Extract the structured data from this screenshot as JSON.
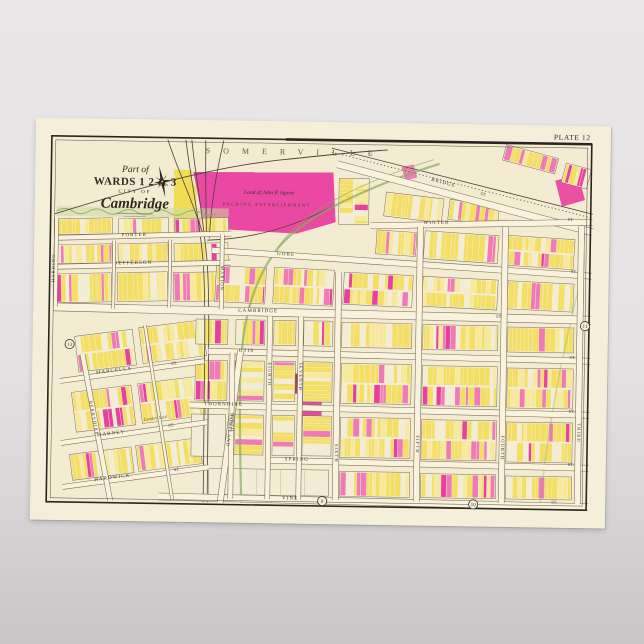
{
  "map": {
    "plate_label": "PLATE 12",
    "boundary_label": "SOMERVILLE",
    "title": {
      "part_of": "Part of",
      "wards": "WARDS 1 2 & 3",
      "city_of": "CITY OF",
      "name": "Cambridge"
    },
    "landmark": {
      "line1": "Land of John P. Squire",
      "line2": "PACKING ESTABLISHMENT"
    },
    "labels": {
      "lumber": "Lumber Yard"
    },
    "plate_refs": [
      {
        "n": "13",
        "x": 37,
        "y": 226
      },
      {
        "n": "11",
        "x": 552,
        "y": 200
      },
      {
        "n": "9",
        "x": 292,
        "y": 379
      },
      {
        "n": "10",
        "x": 443,
        "y": 380
      }
    ],
    "colors": {
      "paper_margin": "#f5efda",
      "paper_map": "#f3ecd2",
      "block": "#f4edd5",
      "line": "#7a6a52",
      "frame": "#2a251e",
      "ink": "#3c352b",
      "street_paper": "#f8f2de",
      "yellow": "#f2df63",
      "pale_yellow": "#f7e99b",
      "pink": "#ef7ab5",
      "magenta": "#e93f9f",
      "maroon": "#a84458",
      "green": "#88a95b",
      "rail": "#4a433a"
    },
    "seed": 11,
    "streets": [
      {
        "l": "BRIDGE",
        "x1": 302,
        "y1": 42,
        "x2": 558,
        "y2": 106,
        "w": 7,
        "lx": 408,
        "ly": 60,
        "lr": 14,
        "l2": {
          "t": "ST",
          "x": 448,
          "y": 71,
          "r": 14
        }
      },
      {
        "l": "WINTER",
        "x1": 336,
        "y1": 103,
        "x2": 558,
        "y2": 96,
        "w": 6,
        "lx": 402,
        "ly": 100,
        "lr": -2,
        "l2": {
          "t": "ST",
          "x": 536,
          "y": 95,
          "r": -2
        }
      },
      {
        "l": "GORE",
        "x1": 178,
        "y1": 130,
        "x2": 558,
        "y2": 150,
        "w": 6,
        "lx": 252,
        "ly": 134,
        "lr": 3,
        "l2": {
          "t": "ST",
          "x": 540,
          "y": 147,
          "r": 3
        }
      },
      {
        "l": "CAMBRIDGE",
        "x1": 20,
        "y1": 189,
        "x2": 558,
        "y2": 194,
        "w": 8,
        "lx": 225,
        "ly": 191,
        "lr": 0,
        "l2": {
          "t": "ST",
          "x": 466,
          "y": 193,
          "r": 0
        }
      },
      {
        "l": "OTIS",
        "x1": 176,
        "y1": 231,
        "x2": 558,
        "y2": 235,
        "w": 6,
        "lx": 214,
        "ly": 231,
        "lr": 0,
        "l2": {
          "t": "ST",
          "x": 540,
          "y": 233,
          "r": 0
        }
      },
      {
        "l": "THORNDIKE",
        "x1": 158,
        "y1": 285,
        "x2": 558,
        "y2": 289,
        "w": 6,
        "lx": 192,
        "ly": 285,
        "lr": 0,
        "l2": {
          "t": "ST",
          "x": 540,
          "y": 287,
          "r": 0
        }
      },
      {
        "l": "SPRING",
        "x1": 234,
        "y1": 339,
        "x2": 558,
        "y2": 342,
        "w": 6,
        "lx": 266,
        "ly": 339,
        "lr": 0,
        "l2": {
          "t": "ST",
          "x": 540,
          "y": 340,
          "r": 0
        }
      },
      {
        "l": "VINE",
        "x1": 128,
        "y1": 377,
        "x2": 558,
        "y2": 381,
        "w": 7,
        "lx": 260,
        "ly": 378,
        "lr": 0,
        "l2": {
          "t": "ST",
          "x": 524,
          "y": 378,
          "r": 0
        }
      },
      {
        "l": "PORTER",
        "x1": 20,
        "y1": 120,
        "x2": 197,
        "y2": 113,
        "w": 5,
        "lx": 100,
        "ly": 117,
        "lr": -2
      },
      {
        "l": "JEFFERSON",
        "x1": 20,
        "y1": 149,
        "x2": 197,
        "y2": 142,
        "w": 5,
        "lx": 100,
        "ly": 145,
        "lr": -2
      },
      {
        "l": "MARCELLA",
        "x1": 28,
        "y1": 263,
        "x2": 172,
        "y2": 241,
        "w": 5,
        "lx": 82,
        "ly": 253,
        "lr": -8,
        "l2": {
          "t": "ST",
          "x": 142,
          "y": 245,
          "r": -8
        }
      },
      {
        "l": "MARNEY",
        "x1": 30,
        "y1": 325,
        "x2": 176,
        "y2": 302,
        "w": 5,
        "lx": 80,
        "ly": 316,
        "lr": -8,
        "l2": {
          "t": "ST",
          "x": 140,
          "y": 307,
          "r": -8
        }
      },
      {
        "l": "HARDWICK",
        "x1": 32,
        "y1": 369,
        "x2": 178,
        "y2": 347,
        "w": 5,
        "lx": 82,
        "ly": 360,
        "lr": -8,
        "l2": {
          "t": "ST",
          "x": 146,
          "y": 351,
          "r": -8
        }
      },
      {
        "l": "HARDING",
        "x1": 22,
        "y1": 100,
        "x2": 22,
        "y2": 189,
        "w": 4,
        "lx": 21,
        "ly": 150,
        "lr": -90
      },
      {
        "l": "MARION",
        "x1": 188,
        "y1": 114,
        "x2": 188,
        "y2": 189,
        "w": 4,
        "lx": 187,
        "ly": 158,
        "lr": 90
      },
      {
        "l": "BERKSHIRE",
        "x1": 50,
        "y1": 236,
        "x2": 80,
        "y2": 382,
        "w": 5,
        "lx": 61,
        "ly": 300,
        "lr": 78
      },
      {
        "l": "PORTLAND",
        "x1": 208,
        "y1": 230,
        "x2": 190,
        "y2": 382,
        "w": 6,
        "lx": 197,
        "ly": 310,
        "lr": 97
      },
      {
        "l": "NINTH",
        "x1": 200,
        "y1": 232,
        "x2": 200,
        "y2": 378,
        "w": 5,
        "lx": 199,
        "ly": 302,
        "lr": 90
      },
      {
        "l": "EIGHTH",
        "x1": 237,
        "y1": 195,
        "x2": 237,
        "y2": 378,
        "w": 5,
        "lx": 236,
        "ly": 253,
        "lr": 90
      },
      {
        "l": "SEVENTH",
        "x1": 268,
        "y1": 195,
        "x2": 268,
        "y2": 378,
        "w": 5,
        "lx": 267,
        "ly": 255,
        "lr": 90
      },
      {
        "l": "SIXTH",
        "x1": 305,
        "y1": 150,
        "x2": 305,
        "y2": 378,
        "w": 6,
        "lx": 304,
        "ly": 331,
        "lr": 90
      },
      {
        "l": "FIFTH",
        "x1": 386,
        "y1": 103,
        "x2": 386,
        "y2": 378,
        "w": 6,
        "lx": 385,
        "ly": 321,
        "lr": 90
      },
      {
        "l": "FOURTH",
        "x1": 471,
        "y1": 102,
        "x2": 471,
        "y2": 378,
        "w": 6,
        "lx": 470,
        "ly": 323,
        "lr": 90
      },
      {
        "l": "THIRD",
        "x1": 547,
        "y1": 100,
        "x2": 547,
        "y2": 378,
        "w": 6,
        "lx": 546,
        "ly": 307,
        "lr": 90
      },
      {
        "l": "",
        "x1": 80,
        "y1": 122,
        "x2": 80,
        "y2": 190,
        "w": 3
      },
      {
        "l": "",
        "x1": 136,
        "y1": 120,
        "x2": 136,
        "y2": 188,
        "w": 3
      },
      {
        "l": "",
        "x1": 112,
        "y1": 206,
        "x2": 142,
        "y2": 380,
        "w": 3
      }
    ],
    "blocks": [
      {
        "x": 22,
        "y": 100,
        "w": 56,
        "h": 16,
        "r": -2
      },
      {
        "x": 84,
        "y": 99,
        "w": 50,
        "h": 16,
        "r": -2
      },
      {
        "x": 140,
        "y": 98,
        "w": 54,
        "h": 16,
        "r": -2
      },
      {
        "x": 22,
        "y": 126,
        "w": 56,
        "h": 19,
        "r": -2
      },
      {
        "x": 84,
        "y": 124,
        "w": 50,
        "h": 19,
        "r": -2
      },
      {
        "x": 140,
        "y": 123,
        "w": 54,
        "h": 19,
        "r": -2
      },
      {
        "x": 22,
        "y": 155,
        "w": 56,
        "h": 29,
        "r": -2
      },
      {
        "x": 84,
        "y": 153,
        "w": 50,
        "h": 29,
        "r": -2
      },
      {
        "x": 140,
        "y": 152,
        "w": 54,
        "h": 29,
        "r": -2
      },
      {
        "x": 44,
        "y": 214,
        "w": 58,
        "h": 36,
        "r": -8
      },
      {
        "x": 108,
        "y": 204,
        "w": 64,
        "h": 36,
        "r": -8
      },
      {
        "x": 42,
        "y": 270,
        "w": 60,
        "h": 40,
        "r": -8
      },
      {
        "x": 108,
        "y": 260,
        "w": 64,
        "h": 40,
        "r": -8
      },
      {
        "x": 40,
        "y": 332,
        "w": 62,
        "h": 26,
        "r": -8
      },
      {
        "x": 106,
        "y": 322,
        "w": 64,
        "h": 26,
        "r": -8
      },
      {
        "x": 468,
        "y": 26,
        "w": 54,
        "h": 16,
        "r": 14,
        "p": 1.4
      },
      {
        "x": 528,
        "y": 40,
        "w": 26,
        "h": 20,
        "r": 14,
        "p": 2
      },
      {
        "x": 350,
        "y": 72,
        "w": 58,
        "h": 24,
        "r": 6
      },
      {
        "x": 414,
        "y": 78,
        "w": 50,
        "h": 20,
        "r": 6,
        "p": 1.5
      },
      {
        "x": 304,
        "y": 56,
        "w": 30,
        "h": 46,
        "p": 0.3
      },
      {
        "x": 342,
        "y": 108,
        "w": 40,
        "h": 24,
        "r": 3
      },
      {
        "x": 390,
        "y": 109,
        "w": 74,
        "h": 28,
        "r": 3,
        "p": 1.3
      },
      {
        "x": 472,
        "y": 112,
        "w": 68,
        "h": 30,
        "r": 3,
        "p": 1.6
      },
      {
        "x": 182,
        "y": 146,
        "w": 50,
        "h": 36,
        "r": 2
      },
      {
        "x": 240,
        "y": 147,
        "w": 60,
        "h": 36,
        "r": 2
      },
      {
        "x": 310,
        "y": 151,
        "w": 69,
        "h": 32,
        "r": 2
      },
      {
        "x": 389,
        "y": 154,
        "w": 75,
        "h": 30,
        "r": 2,
        "p": 1.2
      },
      {
        "x": 474,
        "y": 157,
        "w": 66,
        "h": 28,
        "r": 2,
        "p": 1.5
      },
      {
        "x": 163,
        "y": 199,
        "w": 32,
        "h": 25
      },
      {
        "x": 203,
        "y": 199,
        "w": 29,
        "h": 25
      },
      {
        "x": 241,
        "y": 199,
        "w": 22,
        "h": 25
      },
      {
        "x": 271,
        "y": 199,
        "w": 29,
        "h": 25
      },
      {
        "x": 309,
        "y": 200,
        "w": 70,
        "h": 25,
        "p": 1.2
      },
      {
        "x": 390,
        "y": 201,
        "w": 75,
        "h": 25
      },
      {
        "x": 475,
        "y": 202,
        "w": 66,
        "h": 25,
        "p": 1.3
      },
      {
        "x": 163,
        "y": 240,
        "w": 32,
        "h": 40
      },
      {
        "x": 203,
        "y": 240,
        "w": 29,
        "h": 40
      },
      {
        "x": 241,
        "y": 240,
        "w": 22,
        "h": 40
      },
      {
        "x": 271,
        "y": 240,
        "w": 29,
        "h": 40
      },
      {
        "x": 309,
        "y": 241,
        "w": 70,
        "h": 40,
        "p": 1.2
      },
      {
        "x": 390,
        "y": 242,
        "w": 75,
        "h": 40,
        "p": 1.1
      },
      {
        "x": 475,
        "y": 243,
        "w": 66,
        "h": 40,
        "p": 1.5
      },
      {
        "x": 203,
        "y": 294,
        "w": 29,
        "h": 40
      },
      {
        "x": 241,
        "y": 294,
        "w": 22,
        "h": 40
      },
      {
        "x": 271,
        "y": 294,
        "w": 29,
        "h": 40
      },
      {
        "x": 309,
        "y": 295,
        "w": 70,
        "h": 40,
        "p": 1.5
      },
      {
        "x": 390,
        "y": 296,
        "w": 75,
        "h": 40,
        "p": 1.2
      },
      {
        "x": 475,
        "y": 297,
        "w": 66,
        "h": 40,
        "p": 1.4
      },
      {
        "x": 160,
        "y": 294,
        "w": 34,
        "h": 42,
        "d": 0
      },
      {
        "x": 178,
        "y": 348,
        "w": 120,
        "h": 26,
        "d": 0
      },
      {
        "x": 309,
        "y": 349,
        "w": 70,
        "h": 25
      },
      {
        "x": 390,
        "y": 350,
        "w": 75,
        "h": 24
      },
      {
        "x": 475,
        "y": 351,
        "w": 66,
        "h": 23,
        "p": 1.2
      },
      {
        "x": 550,
        "y": 108,
        "w": 6,
        "h": 270,
        "d": 0
      }
    ],
    "areas": [
      {
        "d": "M158,52 L298,50 L301,100 L262,112 L170,108 Z",
        "f": "#e93f9f",
        "o": 0.95
      },
      {
        "d": "M139,50 h18 v60 h-18 Z",
        "f": "#f0dc55",
        "o": 1
      },
      {
        "d": "M152,64 l9,1 1,34 -9,-1 Z",
        "f": "#f0dc55",
        "o": 1
      },
      {
        "d": "M520,55 l23,-6 7,25 -23,7 Z",
        "f": "#e93f9f",
        "o": 0.9
      },
      {
        "d": "M366,44 l12,-3 4,13 -12,3 Z",
        "f": "#ee72b0",
        "o": 0.9
      },
      {
        "d": "M262,252 h38 v20 h-38 Z",
        "f": "#a84458",
        "o": 1
      },
      {
        "d": "M266,278 h24 v24 h-24 Z",
        "f": "#db4f9b",
        "o": 1
      },
      {
        "d": "M22,88 h172 v10 h-172 Z",
        "f": "#cdd8a2",
        "o": 0.55
      }
    ],
    "greens": [
      {
        "d": "M404,40 C332,64 264,96 240,132 C218,164 208,205 208,262 C208,312 210,350 211,382",
        "w": 2.2,
        "o": 0.7
      },
      {
        "d": "M398,36 C330,58 268,88 244,126",
        "w": 1,
        "o": 0.6
      },
      {
        "d": "M305,198 L305,378",
        "w": 3.5,
        "o": 0.3
      },
      {
        "d": "M130,379 L556,382",
        "w": 3,
        "o": 0.4
      },
      {
        "d": "M548,150 C530,226 516,300 510,380",
        "w": 1.4,
        "o": 0.35
      },
      {
        "d": "M22,93 q8,-5 16,0 t16,0 t16,0 t16,0 t16,0 t16,0 t16,0 t16,0 t16,0 t16,0",
        "w": 1,
        "o": 0.8
      }
    ],
    "rails": [
      {
        "d": "M150,20 C156,62 165,100 169,140 C173,180 172,260 173,382"
      },
      {
        "d": "M156,20 C161,62 169,100 173,140 C177,180 176,262 177,382"
      },
      {
        "d": "M132,20 C143,52 158,82 168,112"
      },
      {
        "d": "M170,20 C170,52 171,82 172,112"
      },
      {
        "d": "M188,20 C181,52 176,86 175,118"
      },
      {
        "d": "M296,26 L558,88"
      },
      {
        "d": "M296,30 L558,92",
        "dash": "1.2,2.4"
      },
      {
        "d": "M173,120 C220,118 262,104 298,84"
      }
    ],
    "boundary_curve": "M20,96 C100,70 178,46 250,38 C292,33 322,29 352,27"
  }
}
